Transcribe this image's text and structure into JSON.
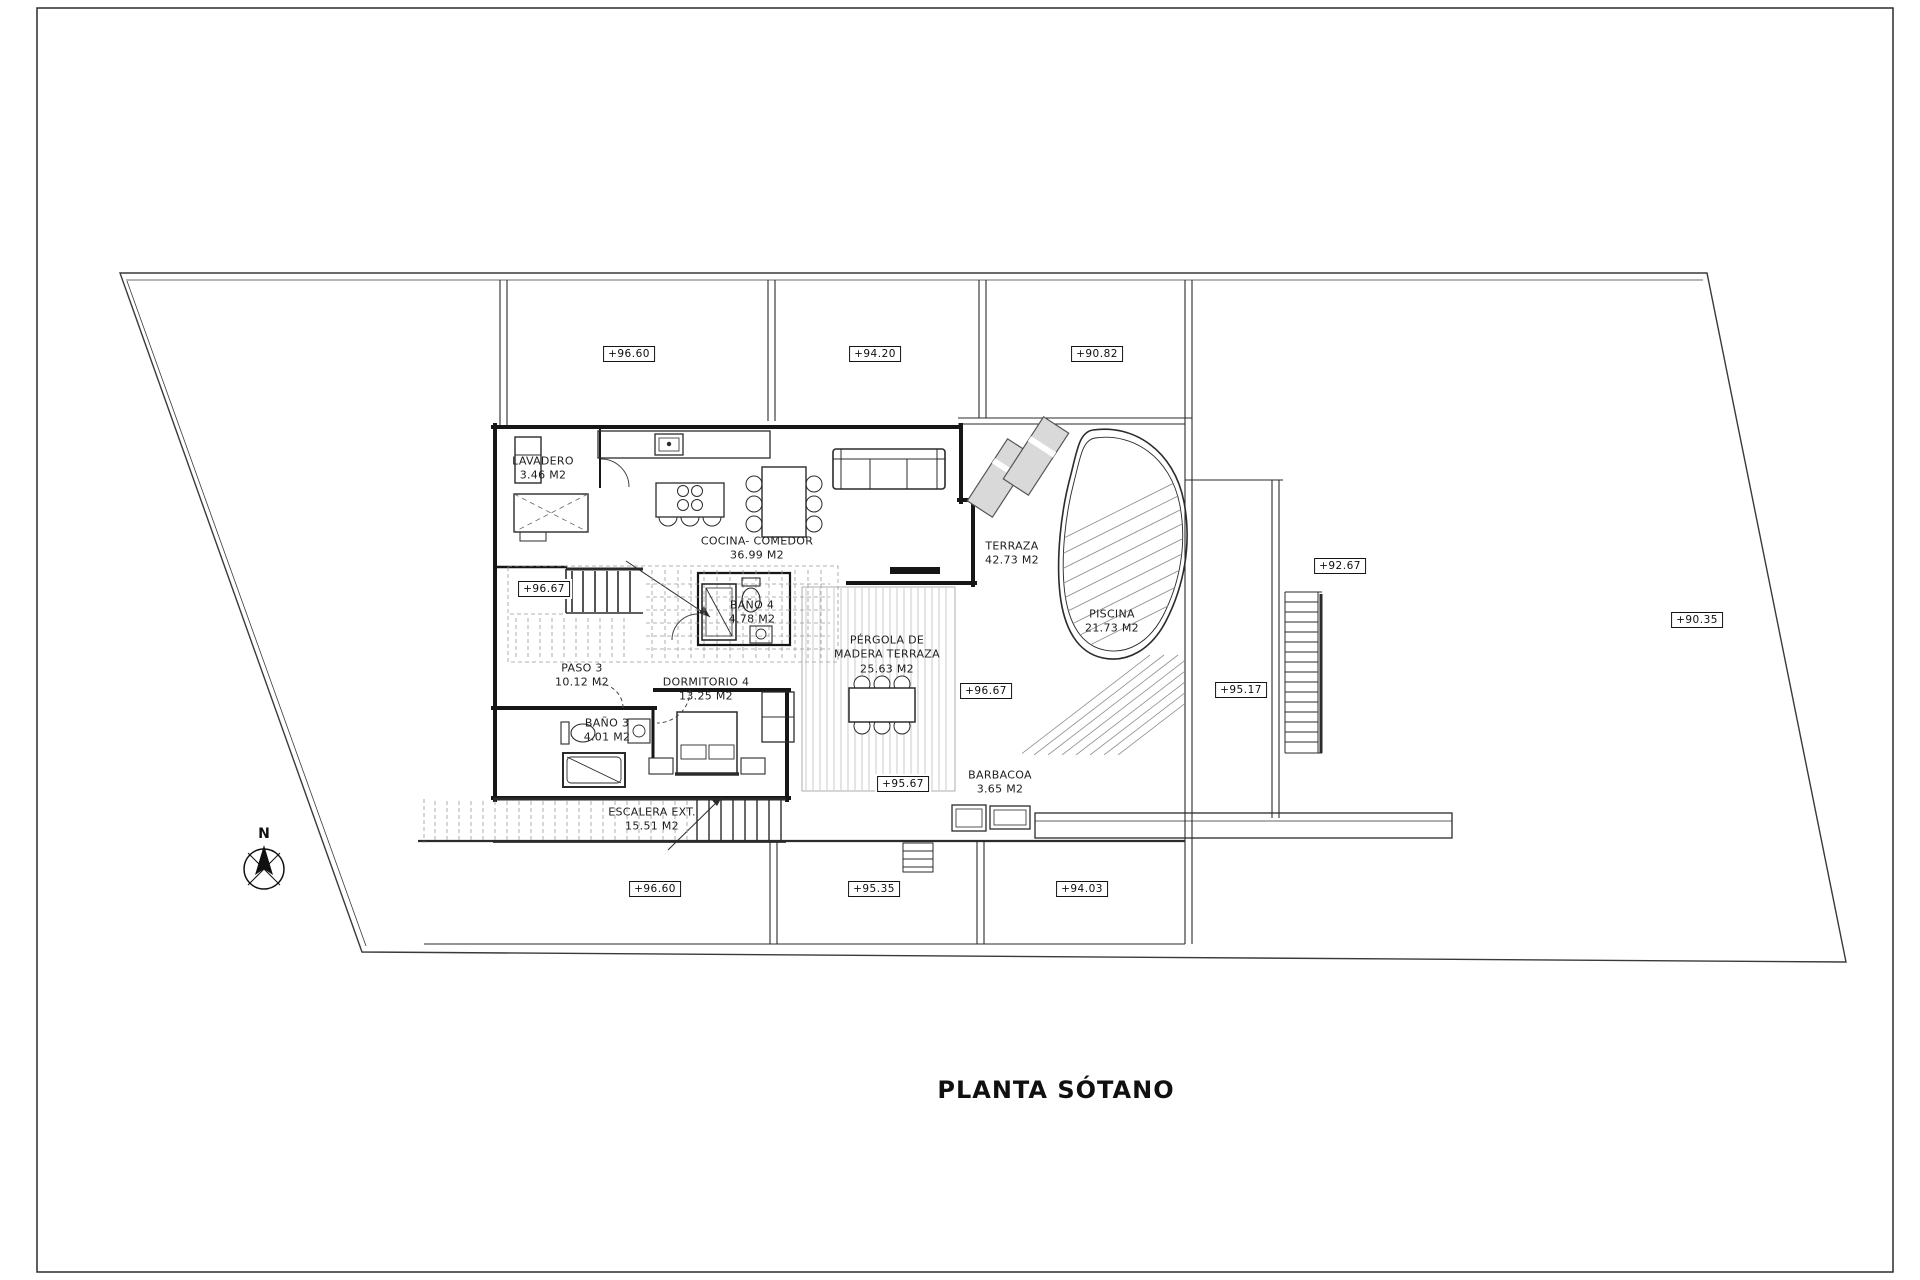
{
  "page": {
    "title": "PLANTA SÓTANO"
  },
  "compass": {
    "north_label": "N"
  },
  "rooms": [
    {
      "name": "LAVADERO",
      "area": "3.46 M2"
    },
    {
      "name": "COCINA- COMEDOR",
      "area": "36.99 M2"
    },
    {
      "name": "TERRAZA",
      "area": "42.73 M2"
    },
    {
      "name": "PISCINA",
      "area": "21.73 M2"
    },
    {
      "name": "PÉRGOLA DE MADERA TERRAZA",
      "area": "25.63 M2"
    },
    {
      "name": "BAÑO 4",
      "area": "4.78 M2"
    },
    {
      "name": "PASO 3",
      "area": "10.12 M2"
    },
    {
      "name": "DORMITORIO 4",
      "area": "13.25 M2"
    },
    {
      "name": "BAÑO 3",
      "area": "4.01 M2"
    },
    {
      "name": "ESCALERA EXT.",
      "area": "15.51 M2"
    },
    {
      "name": "BARBACOA",
      "area": "3.65 M2"
    }
  ],
  "elevation_markers": [
    {
      "value": "+96.60"
    },
    {
      "value": "+94.20"
    },
    {
      "value": "+90.82"
    },
    {
      "value": "+92.67"
    },
    {
      "value": "+90.35"
    },
    {
      "value": "+95.17"
    },
    {
      "value": "+96.67"
    },
    {
      "value": "+96.67"
    },
    {
      "value": "+95.67"
    },
    {
      "value": "+96.60"
    },
    {
      "value": "+95.35"
    },
    {
      "value": "+94.03"
    }
  ],
  "colors": {
    "line": "#2b2b2b",
    "wall": "#161616",
    "hatch": "#9a9a9a"
  }
}
